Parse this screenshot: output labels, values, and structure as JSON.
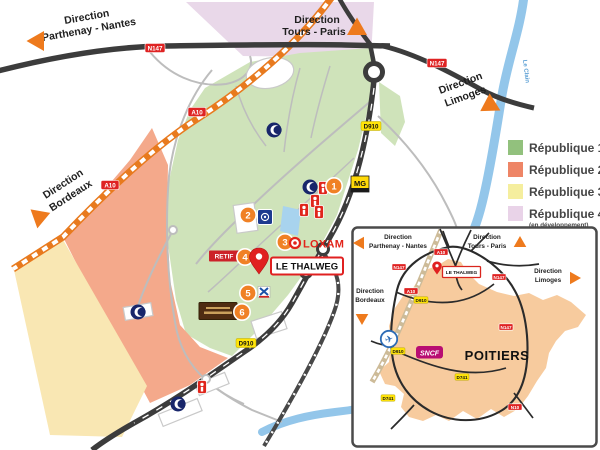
{
  "colors": {
    "zone_republique_1": "#cfe3ba",
    "zone_republique_2": "#f4a98b",
    "zone_republique_3": "#f9e7b3",
    "zone_republique_4": "#e9d8e9",
    "road_dark": "#3c3c3c",
    "river_blue": "#93c6ea",
    "accent_orange": "#ee7a1d",
    "badge_red": "#df2323",
    "badge_yellow": "#ffe309",
    "loxam_red": "#e2231a",
    "sncf_magenta": "#b80d72",
    "poitiers_fill": "#f7cb9e"
  },
  "main_map": {
    "directions": {
      "parthenay": {
        "line1": "Direction",
        "line2": "Parthenay - Nantes"
      },
      "tours": {
        "line1": "Direction",
        "line2": "Tours - Paris"
      },
      "limoges": {
        "line1": "Direction",
        "line2": "Limoges"
      },
      "bordeaux": {
        "line1": "Direction",
        "line2": "Bordeaux"
      }
    },
    "road_badges": [
      "N147",
      "N147",
      "A10",
      "A10",
      "D910",
      "D910"
    ],
    "river_label": "Le Clain",
    "numbered_markers": [
      "1",
      "2",
      "3",
      "4",
      "5",
      "6"
    ],
    "loxam_label": "LOXAM",
    "thalweg_label": "LE THALWEG",
    "retif_label": "RETIF",
    "mg_label": "MG"
  },
  "legend": {
    "items": [
      {
        "label": "République 1",
        "color": "#92c17d"
      },
      {
        "label": "République 2",
        "color": "#ee8566"
      },
      {
        "label": "République 3",
        "color": "#f5ee9e"
      },
      {
        "label": "République 4",
        "color": "#e9d3e8",
        "note": "(en développement)"
      }
    ]
  },
  "inset": {
    "directions": {
      "parthenay": {
        "line1": "Direction",
        "line2": "Parthenay - Nantes"
      },
      "tours": {
        "line1": "Direction",
        "line2": "Tours - Paris"
      },
      "limoges": {
        "line1": "Direction",
        "line2": "Limoges"
      },
      "bordeaux": {
        "line1": "Direction",
        "line2": "Bordeaux"
      }
    },
    "city_label": "POITIERS",
    "sncf_label": "SNCF",
    "thalweg_label": "LE THALWEG",
    "road_badges": [
      {
        "label": "A10",
        "type": "red"
      },
      {
        "label": "N147",
        "type": "red"
      },
      {
        "label": "A10",
        "type": "red"
      },
      {
        "label": "D910",
        "type": "yellow"
      },
      {
        "label": "N147",
        "type": "red"
      },
      {
        "label": "N147",
        "type": "red"
      },
      {
        "label": "D910",
        "type": "yellow"
      },
      {
        "label": "D741",
        "type": "yellow"
      },
      {
        "label": "D741",
        "type": "yellow"
      },
      {
        "label": "N10",
        "type": "red"
      }
    ]
  }
}
